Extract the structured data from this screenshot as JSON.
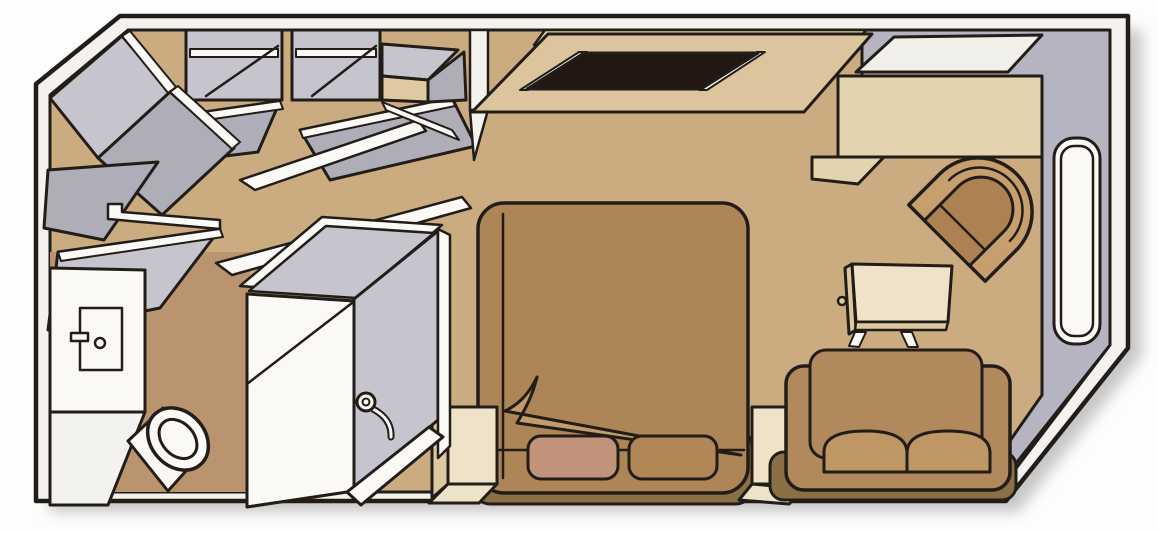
{
  "scene": {
    "name": "stateroom-floor-plan",
    "kind": "isometric cabin illustration",
    "rooms": [
      "bathroom",
      "entry",
      "sleeping-area",
      "sitting-area"
    ]
  },
  "palette": {
    "background": "#fdfdfd",
    "outline": "#221d18",
    "wall_band": "#f4f2ee",
    "wall_gray": "#b7b4c1",
    "closet_gray": "#c6c5cd",
    "closet_gray_dark": "#aeadb8",
    "floor": "#cbab80",
    "floor_bath": "#b9946e",
    "ledge_khaki": "#d8d3a5",
    "cabinet_beige": "#dcc49d",
    "safe_beige": "#dfc9a1",
    "tv_screen": "#221712",
    "desk_top": "#f1efe9",
    "desk_front": "#e3d3ae",
    "bed_brown": "#ae8557",
    "bed_fold": "#c49c6b",
    "bed_base": "#8a7044",
    "pillow_pink": "#c2937b",
    "pillow_brown": "#b28757",
    "cream": "#eee3c8",
    "cream_side": "#dcc9a0",
    "sofa_brown": "#b2895c",
    "sofa_cushion": "#bf9765",
    "chair_outer": "#c79f6f",
    "chair_inner": "#ad8253",
    "white": "#faf9f5",
    "shadow": "#9a9a9a"
  },
  "elements": {
    "corner_wardrobe": "corner wardrobe with open door",
    "wardrobe_1": "wardrobe bay with hanging rail",
    "wardrobe_2": "wardrobe bay with hanging rail",
    "safe": "cabinet with open door",
    "tv_unit": "TV cabinet",
    "tv": "television screen",
    "desk": "desk",
    "chair": "tub chair",
    "window": "window",
    "bed": "double bed with turned-down blanket",
    "pillow_left": "pillow",
    "pillow_right": "pillow",
    "nightstand_left": "nightstand",
    "nightstand_right": "nightstand",
    "side_table": "side table",
    "sofa": "two-seat sofa",
    "vanity": "bathroom vanity cabinet",
    "toilet": "toilet",
    "shower": "shower enclosure",
    "shower_head": "shower head"
  }
}
